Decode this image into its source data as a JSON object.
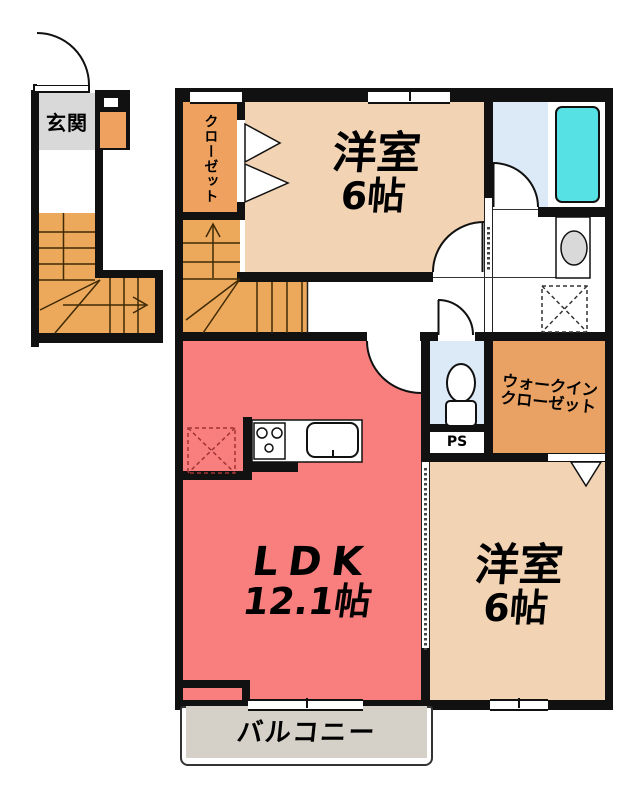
{
  "floorplan": {
    "rooms": {
      "entrance": {
        "label": "玄関"
      },
      "closet": {
        "label": "クローゼット"
      },
      "bedroom_top": {
        "name": "洋室",
        "size": "6帖"
      },
      "walk_in_closet": {
        "line1": "ウォークイン",
        "line2": "クローゼット"
      },
      "pipe_space": {
        "label": "PS"
      },
      "ldk": {
        "name": "LDK",
        "size": "12.1帖"
      },
      "bedroom_right": {
        "name": "洋室",
        "size": "6帖"
      },
      "balcony": {
        "label": "バルコニー"
      }
    },
    "colors": {
      "wall": "#111111",
      "ldk_floor": "#f97f7f",
      "bedroom_floor": "#f2d3b3",
      "closet_floor": "#efa160",
      "walk_in_closet_floor": "#e9a263",
      "stairs": "#eca95c",
      "stair_lines": "#3f2a05",
      "wet_area_floor": "#dceaf8",
      "bathtub": "#56e2e4",
      "entrance_floor": "#d9d9d9",
      "balcony_floor": "#d6d1c8"
    }
  }
}
